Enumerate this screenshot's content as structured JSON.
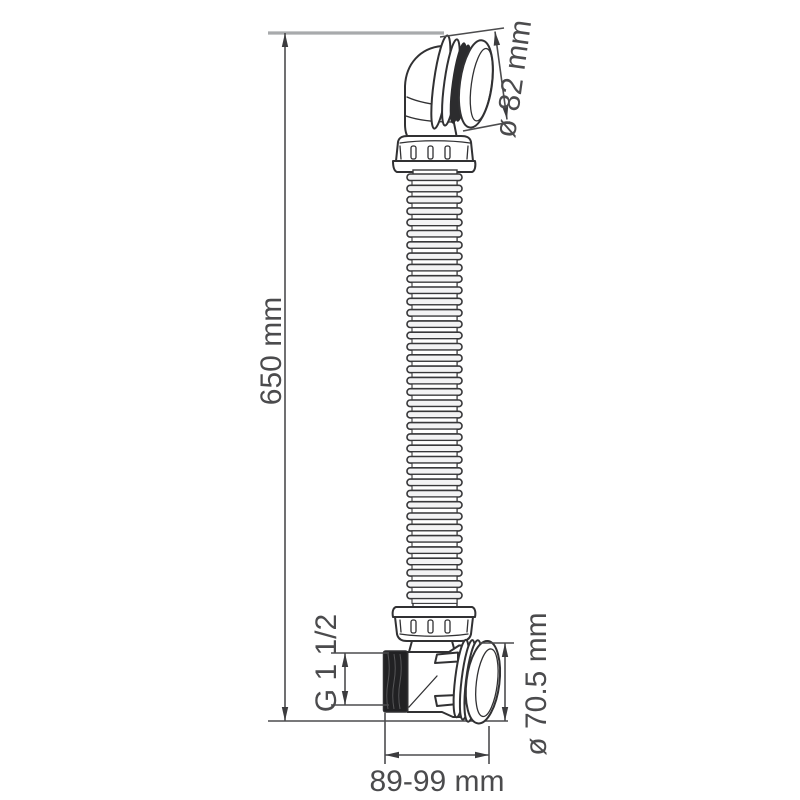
{
  "diagram": {
    "type": "technical-dimension-drawing",
    "subject": "bath drain elbow with flexible corrugated hose and overflow cap",
    "dimension_labels": {
      "overall_height": "650 mm",
      "cap_diameter": "ø 82 mm",
      "thread_size": "G 1 1/2",
      "cover_diameter": "ø 70.5 mm",
      "horizontal_span": "89-99 mm"
    },
    "dimension_values": {
      "overall_height_mm": 650,
      "cap_diameter_mm": 82,
      "cover_diameter_mm": 70.5,
      "horizontal_span_min_mm": 89,
      "horizontal_span_max_mm": 99
    },
    "colors": {
      "background": "#ffffff",
      "outline": "#313133",
      "dimension_lines": "#4c4c4e",
      "extension_line_gray": "#a8aaac",
      "label_text": "#4b4b4d",
      "thread_fill": "#212123"
    }
  }
}
